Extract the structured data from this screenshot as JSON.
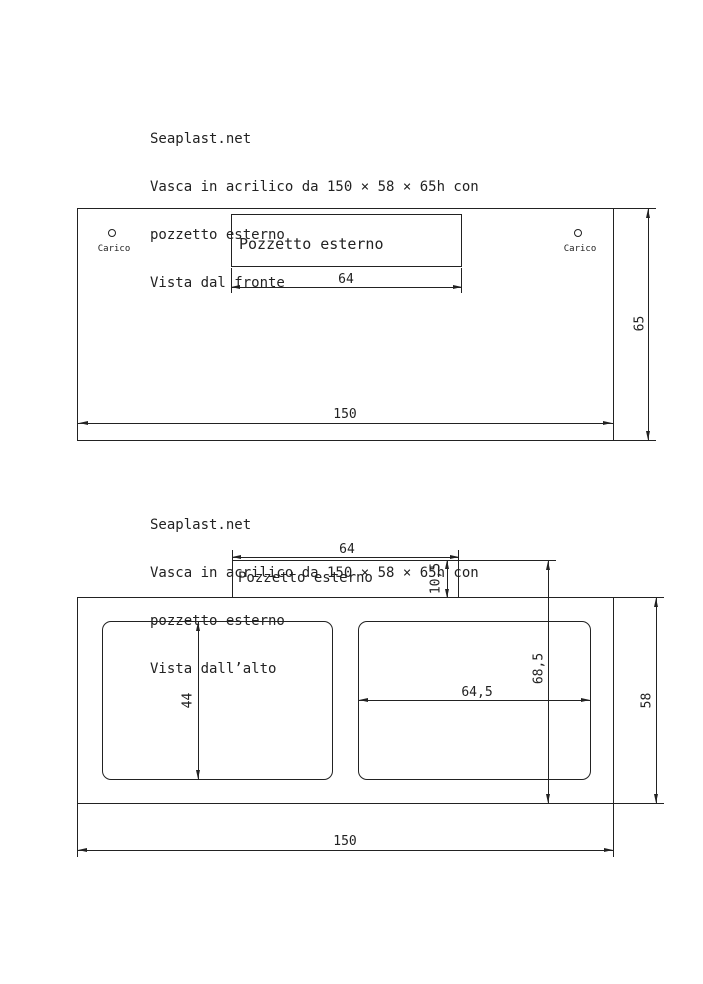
{
  "colors": {
    "line": "#222222",
    "background": "#ffffff"
  },
  "front_view": {
    "header": {
      "brand": "Seaplast.net",
      "desc_line1": "Vasca in acrilico da 150 × 58 × 65h con",
      "desc_line2": "pozzetto esterno",
      "view_name": "Vista dal fronte"
    },
    "pozzetto_label": "Pozzetto esterno",
    "carico_left": "Carico",
    "carico_right": "Carico",
    "dim_pozzetto_width": "64",
    "dim_tank_width": "150",
    "dim_tank_height": "65"
  },
  "top_view": {
    "header": {
      "brand": "Seaplast.net",
      "desc_line1": "Vasca in acrilico da 150 × 58 × 65h con",
      "desc_line2": "pozzetto esterno",
      "view_name": "Vista dall’alto"
    },
    "pozzetto_label": "Pozzetto esterno",
    "dim_pozzetto_width": "64",
    "dim_pozzetto_depth": "10,5",
    "dim_overall_depth": "68,5",
    "dim_left_opening_depth": "44",
    "dim_right_opening_width": "64,5",
    "dim_tank_depth": "58",
    "dim_tank_width": "150"
  }
}
